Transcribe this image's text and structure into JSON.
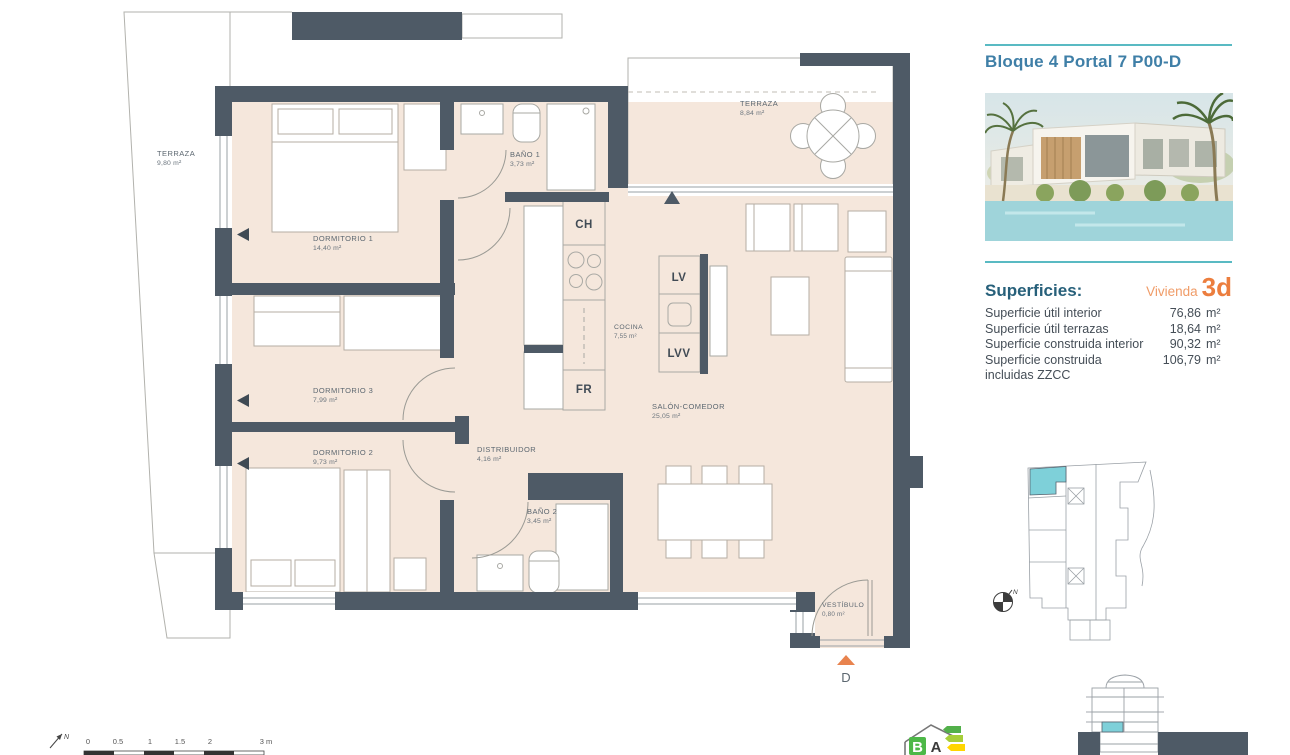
{
  "sidebar": {
    "title": "Bloque 4 Portal 7 P00-D",
    "superficies": {
      "heading": "Superficies:",
      "vivienda_label": "Vivienda",
      "vivienda_number": "3d",
      "rows": [
        {
          "label": "Superficie útil interior",
          "value": "76,86",
          "unit": "m²"
        },
        {
          "label": "Superficie útil terrazas",
          "value": "18,64",
          "unit": "m²"
        },
        {
          "label": "Superficie construida interior",
          "value": "90,32",
          "unit": "m²"
        },
        {
          "label": "Superficie construida incluidas ZZCC",
          "value": "106,79",
          "unit": "m²"
        }
      ]
    }
  },
  "plan": {
    "rooms": [
      {
        "name": "TERRAZA",
        "area": "9,80 m²"
      },
      {
        "name": "DORMITORIO 1",
        "area": "14,40 m²"
      },
      {
        "name": "BAÑO 1",
        "area": "3,73 m²"
      },
      {
        "name": "TERRAZA",
        "area": "8,84 m²"
      },
      {
        "name": "COCINA",
        "area": "7,55 m²"
      },
      {
        "name": "SALÓN-COMEDOR",
        "area": "25,05 m²"
      },
      {
        "name": "DORMITORIO 3",
        "area": "7,99 m²"
      },
      {
        "name": "DORMITORIO 2",
        "area": "9,73 m²"
      },
      {
        "name": "DISTRIBUIDOR",
        "area": "4,16 m²"
      },
      {
        "name": "BAÑO 2",
        "area": "3,45 m²"
      },
      {
        "name": "VESTÍBULO",
        "area": "0,80 m²"
      }
    ],
    "appliances": {
      "ch": "CH",
      "lv": "LV",
      "lvv": "LVV",
      "fr": "FR"
    },
    "entrance_letter": "D",
    "compass_letter": "N"
  },
  "scalebar": {
    "ticks": [
      "0",
      "0.5",
      "1",
      "1.5",
      "2",
      "3 m"
    ],
    "north_letter": "N"
  },
  "energy_logo": {
    "letters": [
      "B",
      "A"
    ]
  },
  "colors": {
    "wall": "#4e5a66",
    "floor": "#f5e7dc",
    "terrace": "#e7e6e2",
    "teal": "#59bac3",
    "accent_orange": "#ec7e3e",
    "title_blue": "#3f7fa7",
    "unit_highlight": "#7ed0d9"
  }
}
